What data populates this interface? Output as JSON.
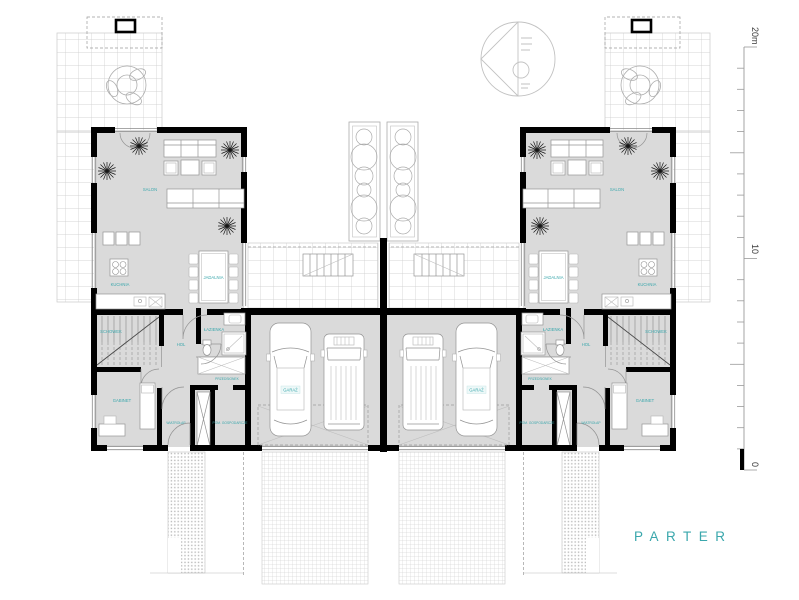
{
  "title": "PARTER",
  "accent_color": "#3aa7ac",
  "rooms": {
    "salon": "SALON",
    "kuchnia": "KUCHNIA",
    "jadalnia": "JADALNIA",
    "schowek": "SCHOWEK",
    "hol": "HOL",
    "lazienka": "ŁAZIENKA",
    "gabinet": "GABINET",
    "przedsionek": "PRZEDSIONEK",
    "wiatrolap": "WIATROŁAP",
    "pom_gospodarcze": "POM. GOSPODARCZE",
    "garaz": "GARAŻ"
  },
  "scale_bar": {
    "top_label": "20m",
    "mid_label": "10",
    "bottom_label": "0"
  }
}
